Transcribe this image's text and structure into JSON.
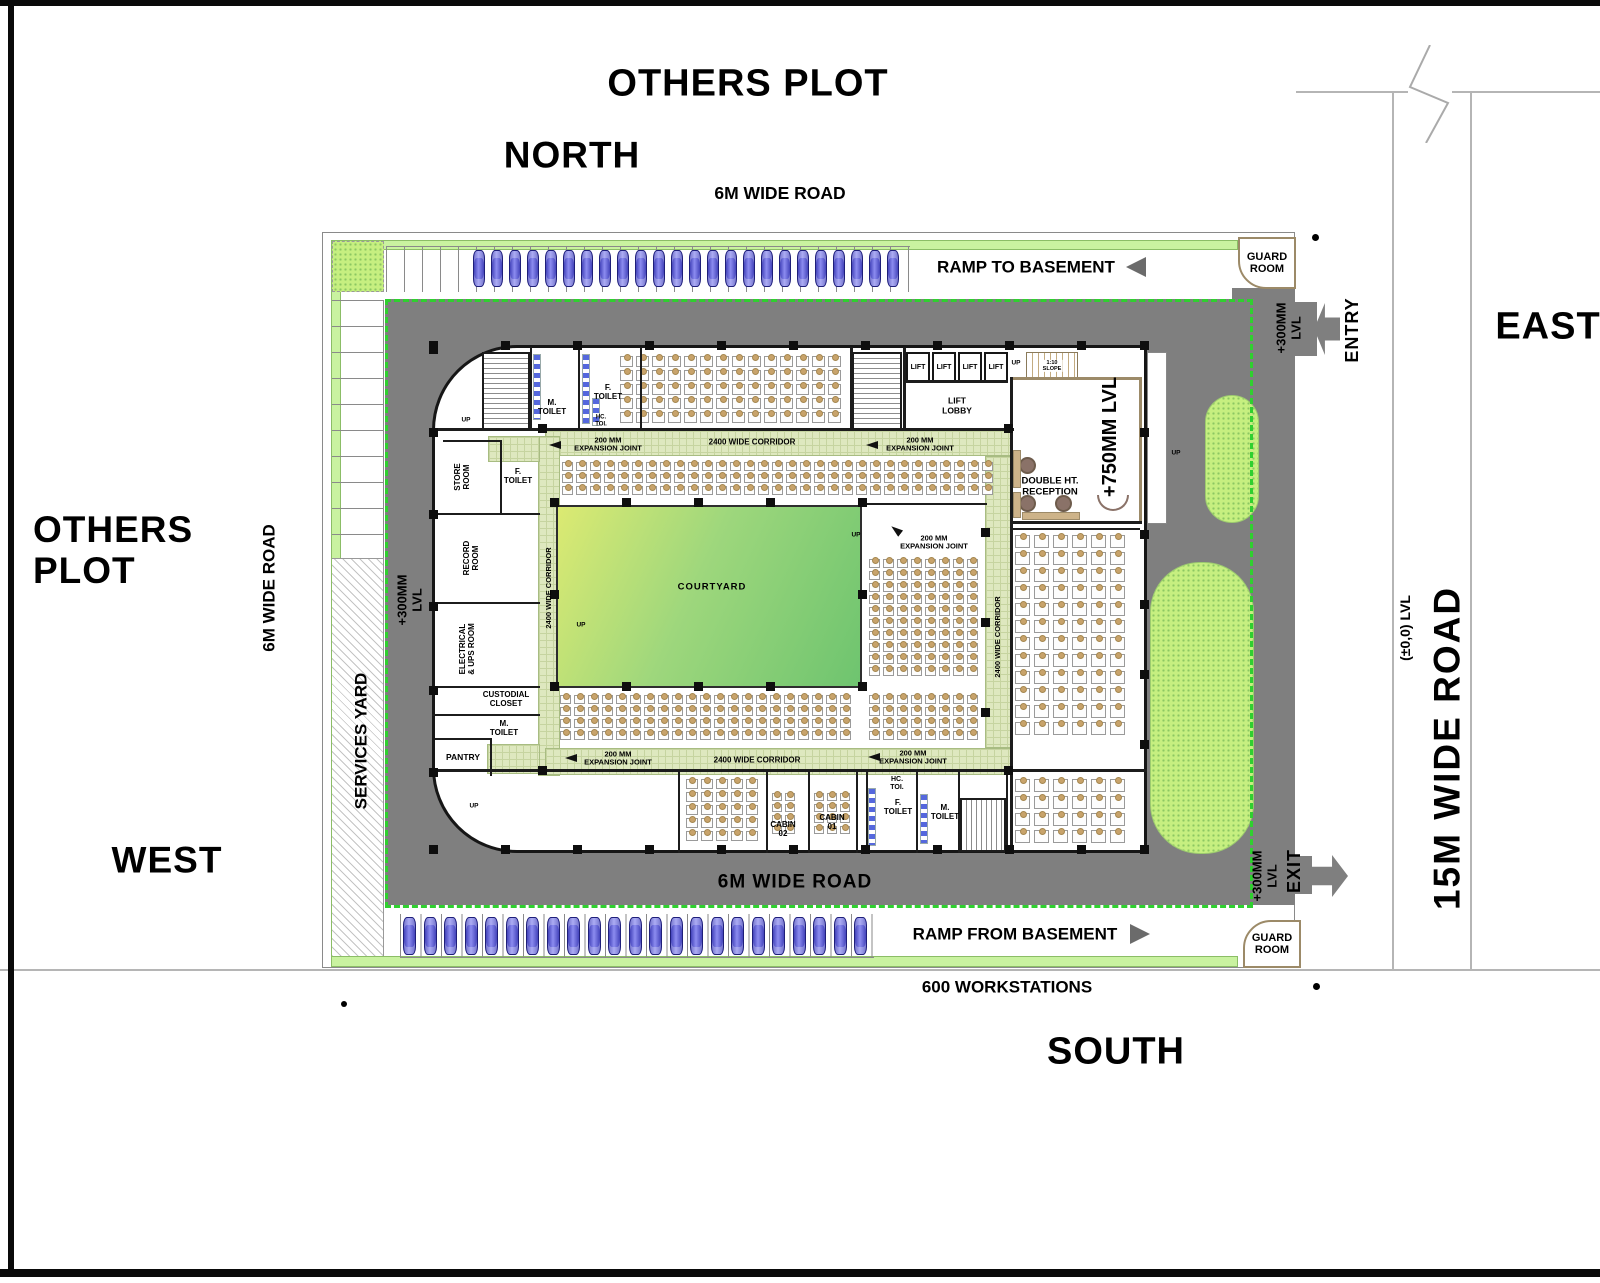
{
  "compass": {
    "north": "NORTH",
    "south": "SOUTH",
    "east": "EAST",
    "west": "WEST"
  },
  "plots": {
    "top": "OTHERS PLOT",
    "left_l1": "OTHERS",
    "left_l2": "PLOT"
  },
  "roads": {
    "top": "6M WIDE ROAD",
    "left": "6M WIDE ROAD",
    "bottom": "6M WIDE ROAD",
    "right": "15M WIDE ROAD",
    "right_level": "(±0,0) LVL"
  },
  "site": {
    "services_yard": "SERVICES YARD",
    "guard_l1": "GUARD",
    "guard_l2": "ROOM",
    "entry": "ENTRY",
    "exit": "EXIT",
    "ramp_to": "RAMP TO BASEMENT",
    "ramp_from": "RAMP FROM BASEMENT",
    "lvl300_l1": "+300MM",
    "lvl300_l2": "LVL",
    "workstations": "600 WORKSTATIONS"
  },
  "building": {
    "lift": "LIFT",
    "lobby_l1": "LIFT",
    "lobby_l2": "LOBBY",
    "slope_l1": "1:10",
    "slope_l2": "SLOPE",
    "up": "UP",
    "reception_l1": "DOUBLE HT.",
    "reception_l2": "RECEPTION",
    "lvl750": "+750MM LVL",
    "courtyard": "COURTYARD",
    "corridor": "2400 WIDE CORRIDOR",
    "ej_l1": "200 MM",
    "ej_l2": "EXPANSION JOINT",
    "rooms": {
      "store_l1": "STORE",
      "store_l2": "ROOM",
      "f_l1": "F.",
      "f_l2": "TOILET",
      "m_l1": "M.",
      "m_l2": "TOILET",
      "record_l1": "RECORD",
      "record_l2": "ROOM",
      "elec_l1": "ELECTRICAL",
      "elec_l2": "& UPS ROOM",
      "cust_l1": "CUSTODIAL",
      "cust_l2": "CLOSET",
      "pantry": "PANTRY",
      "cabin1_l1": "CABIN",
      "cabin1_l2": "01",
      "cabin2_l1": "CABIN",
      "cabin2_l2": "02",
      "hc_l1": "HC.",
      "hc_l2": "TOI."
    }
  },
  "parking": {
    "top_cars": 24,
    "bottom_cars": 23
  },
  "colors": {
    "road": "#7f7f7f",
    "setback_dashed": "#2fd02f",
    "corridor": "#dee8bf",
    "courtyard_from": "#dcea72",
    "courtyard_to": "#6ec46f",
    "car": "#5c5cd6",
    "green_strip": "#c9f2a0"
  }
}
